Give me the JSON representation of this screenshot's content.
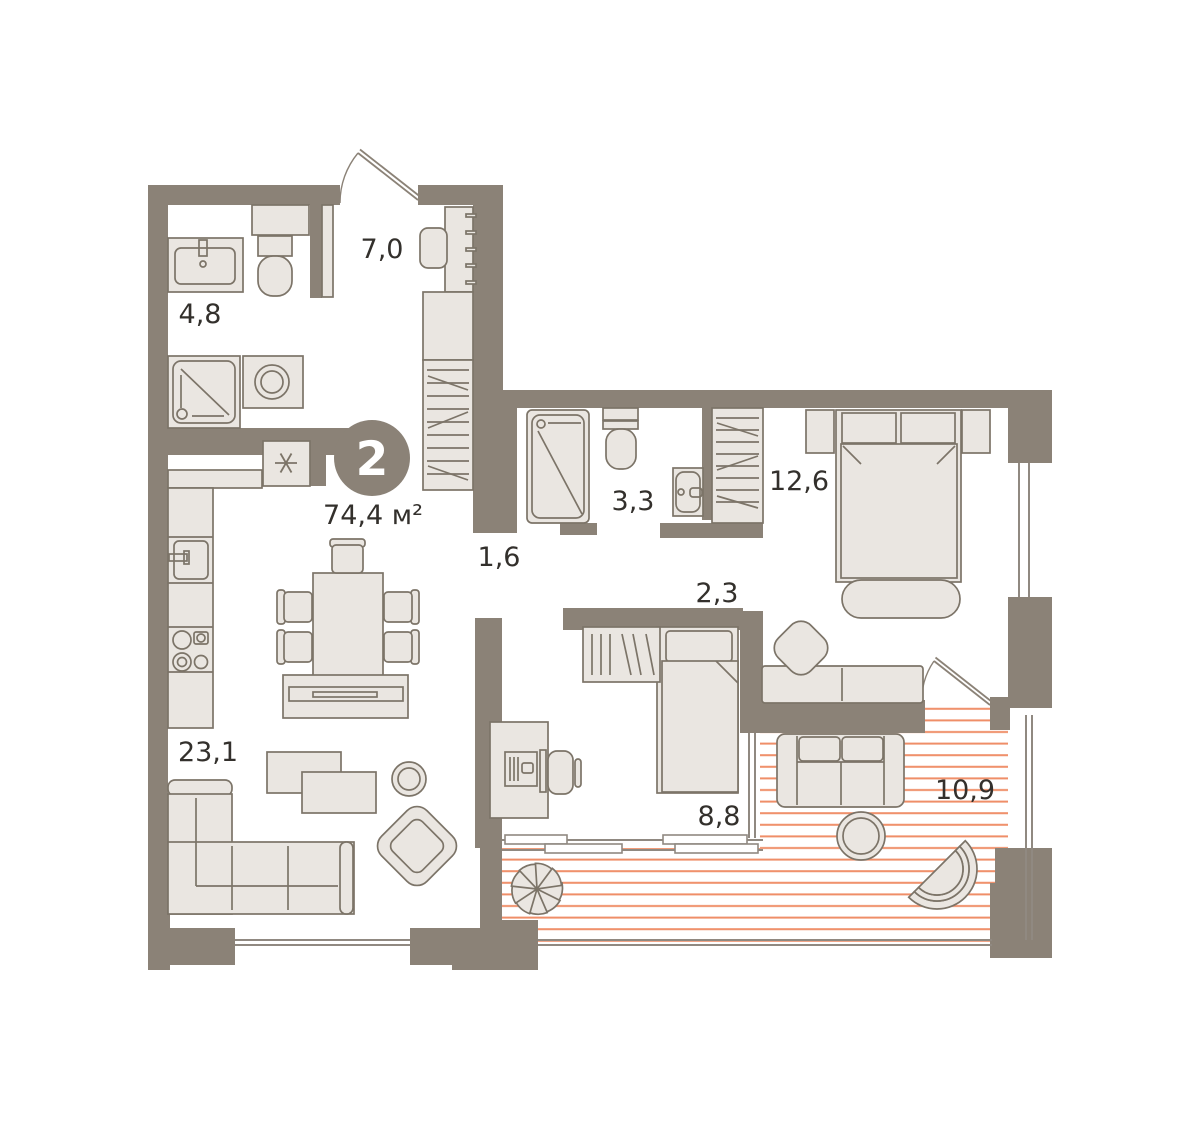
{
  "plan": {
    "type_badge": "2",
    "total_area": "74,4 м²",
    "rooms": [
      {
        "name": "bathroom",
        "area": "4,8"
      },
      {
        "name": "hallway",
        "area": "7,0"
      },
      {
        "name": "shower-room",
        "area": "3,3"
      },
      {
        "name": "bedroom",
        "area": "12,6"
      },
      {
        "name": "corridor",
        "area": "1,6"
      },
      {
        "name": "inner-hall",
        "area": "2,3"
      },
      {
        "name": "living-kitchen",
        "area": "23,1"
      },
      {
        "name": "study",
        "area": "8,8"
      },
      {
        "name": "terrace",
        "area": "10,9"
      }
    ],
    "colors": {
      "wall": "#8B8277",
      "furniture_fill": "#EAE6E1",
      "furniture_stroke": "#7C7468",
      "deck_stripe": "#EF8E68",
      "window": "#908981",
      "text": "#33302C",
      "badge_fill": "#8B8277",
      "badge_text": "#FFFFFF",
      "background": "#FFFFFF"
    }
  }
}
